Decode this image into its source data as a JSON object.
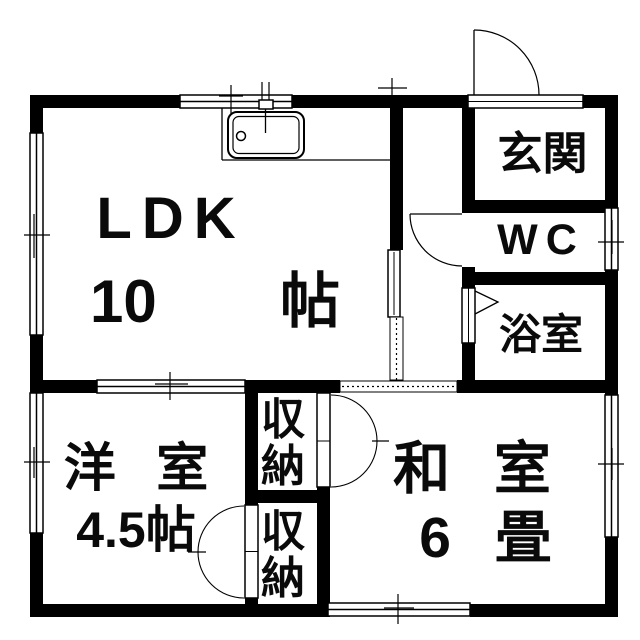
{
  "floorplan": {
    "rooms": {
      "ldk": {
        "name": "LDK",
        "size_value": "10",
        "size_unit": "帖"
      },
      "western_room": {
        "name": "洋 室",
        "size": "4.5帖"
      },
      "japanese_room": {
        "name": "和 室",
        "size": "6 畳"
      },
      "entrance": {
        "name": "玄関"
      },
      "toilet": {
        "name": "WC"
      },
      "bathroom": {
        "name": "浴室"
      },
      "closet_upper": {
        "name": "収納"
      },
      "closet_lower": {
        "name": "収納"
      }
    },
    "icons": {
      "kitchen_sink": "kitchen-sink-icon",
      "entrance_door": "entrance-door-swing-icon",
      "window": "window-icon"
    },
    "colors": {
      "wall": "#000000",
      "background": "#ffffff"
    }
  }
}
